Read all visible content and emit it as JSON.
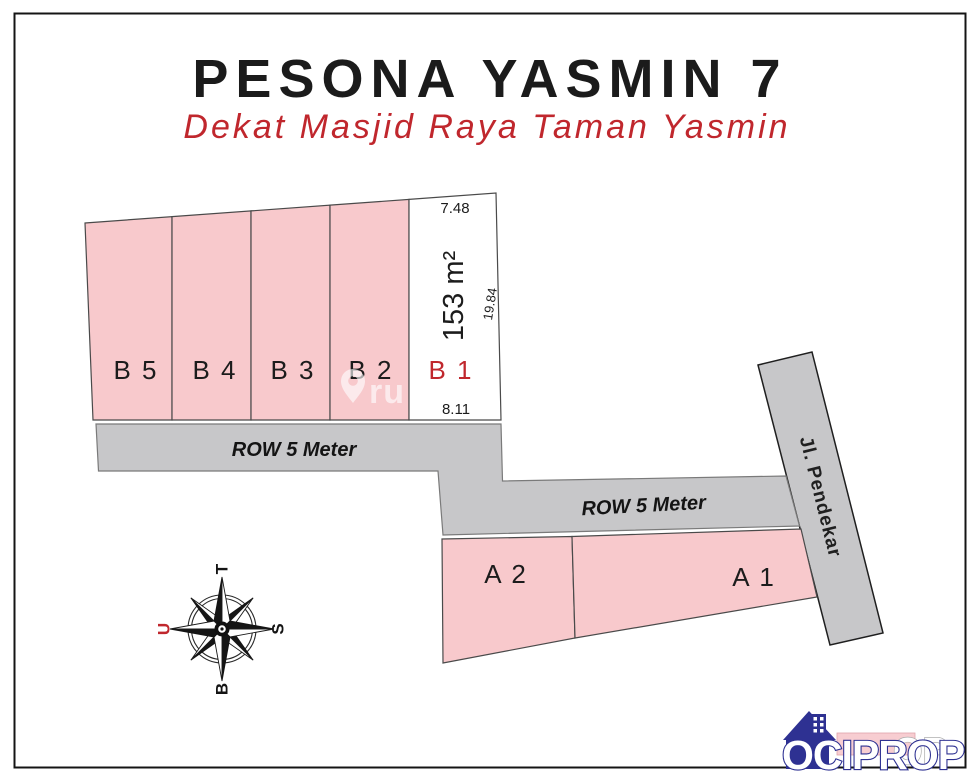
{
  "header": {
    "title": "PESONA YASMIN 7",
    "subtitle": "Dekat Masjid Raya Taman Yasmin"
  },
  "plots": {
    "b5": "B 5",
    "b4": "B 4",
    "b3": "B 3",
    "b2": "B 2",
    "b1": "B 1",
    "a2": "A 2",
    "a1": "A 1"
  },
  "b1_measurements": {
    "top_width": "7.48",
    "area": "153 m²",
    "side_length": "19.84",
    "bottom_width": "8.11"
  },
  "roads": {
    "row_upper": "ROW 5 Meter",
    "row_lower": "ROW 5 Meter",
    "street": "Jl. Pendekar"
  },
  "compass": {
    "top": "T",
    "left": "U",
    "right": "S",
    "bottom": "B"
  },
  "watermark": {
    "text": "ru"
  },
  "logo": {
    "text": "OCIPROP",
    "ghost": "OP"
  },
  "colors": {
    "plot_pink": "#f8c9cc",
    "road_gray": "#c7c7c9",
    "accent_red": "#c0272d",
    "logo_blue": "#2e3192"
  }
}
